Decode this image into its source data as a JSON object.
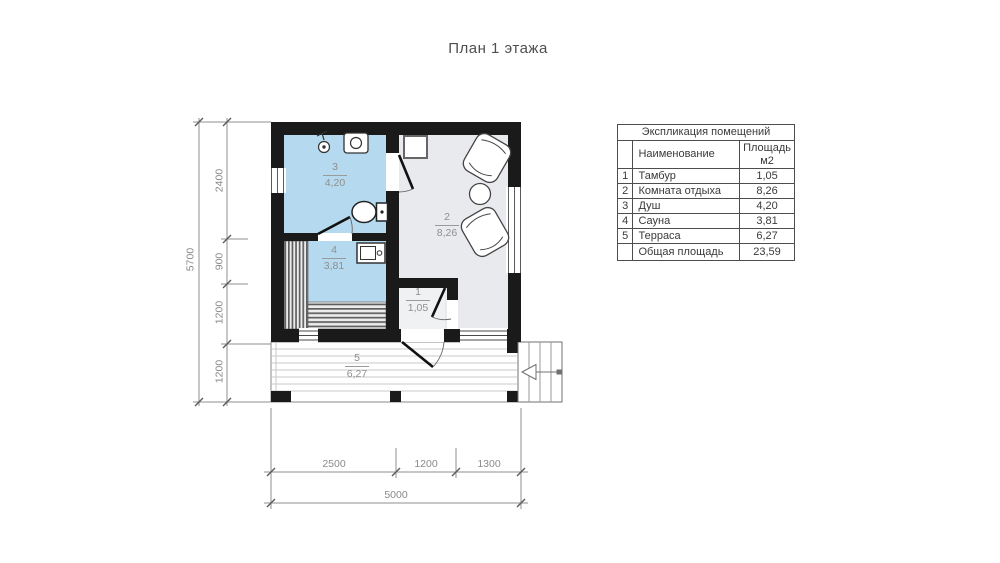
{
  "title": "План 1 этажа",
  "table": {
    "title": "Экспликация помещений",
    "headers": {
      "name": "Наименование",
      "area_line1": "Площадь",
      "area_line2": "м2"
    },
    "rows": [
      {
        "num": "1",
        "name": "Тамбур",
        "area": "1,05"
      },
      {
        "num": "2",
        "name": "Комната отдыха",
        "area": "8,26"
      },
      {
        "num": "3",
        "name": "Душ",
        "area": "4,20"
      },
      {
        "num": "4",
        "name": "Сауна",
        "area": "3,81"
      },
      {
        "num": "5",
        "name": "Терраса",
        "area": "6,27"
      }
    ],
    "total": {
      "name": "Общая площадь",
      "area": "23,59"
    }
  },
  "plan": {
    "labels": [
      {
        "number": "3",
        "area": "4,20"
      },
      {
        "number": "2",
        "area": "8,26"
      },
      {
        "number": "4",
        "area": "3,81"
      },
      {
        "number": "1",
        "area": "1,05"
      },
      {
        "number": "5",
        "area": "6,27"
      }
    ]
  },
  "dimensions": {
    "left": {
      "total": "5700",
      "segments": [
        "2400",
        "900",
        "1200",
        "1200"
      ]
    },
    "bottom": {
      "segments": [
        "2500",
        "1200",
        "1300"
      ],
      "total": "5000"
    }
  },
  "colors": {
    "wall": "#1a1a1a",
    "wet_room": "#b5d9ef",
    "dry_room": "#e8eaed",
    "entry_room": "#f0f1f3"
  }
}
